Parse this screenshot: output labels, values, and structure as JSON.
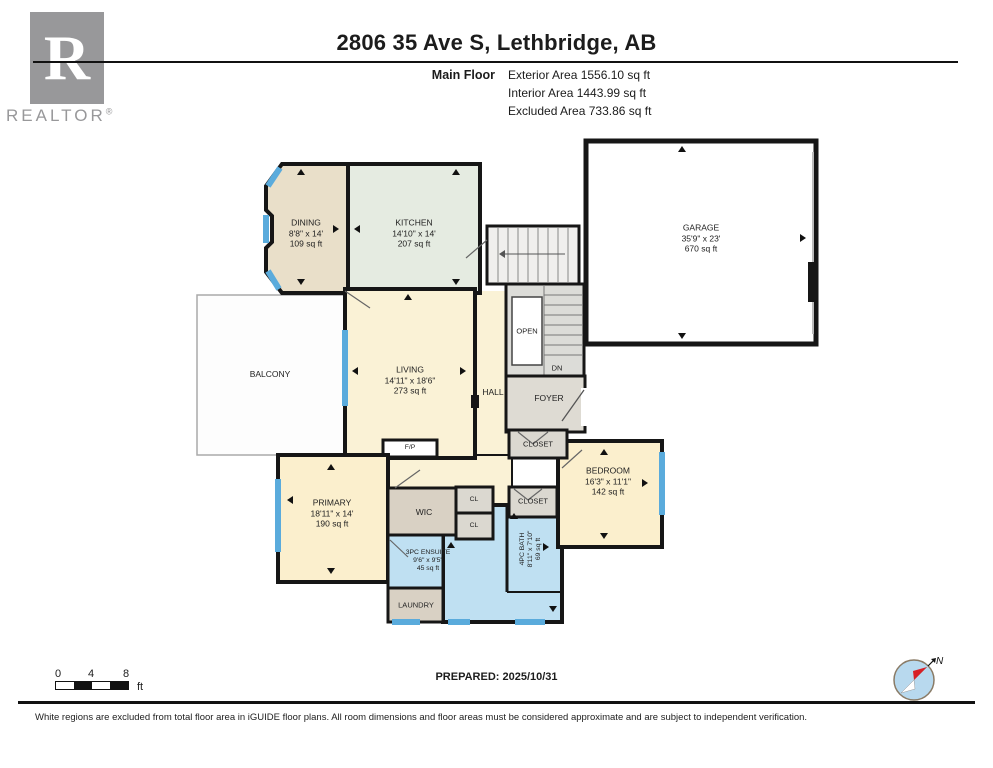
{
  "header": {
    "title": "2806 35 Ave S, Lethbridge, AB",
    "floor_label": "Main Floor",
    "stats": {
      "exterior": "Exterior Area 1556.10 sq ft",
      "interior": "Interior Area 1443.99 sq ft",
      "excluded": "Excluded Area 733.86 sq ft"
    },
    "logo": {
      "letter": "R",
      "word": "REALTOR",
      "registered": "®"
    }
  },
  "rooms": {
    "dining": {
      "name": "DINING",
      "dims": "8'8\" x 14'",
      "area": "109 sq ft"
    },
    "kitchen": {
      "name": "KITCHEN",
      "dims": "14'10\" x 14'",
      "area": "207 sq ft"
    },
    "garage": {
      "name": "GARAGE",
      "dims": "35'9\" x 23'",
      "area": "670 sq ft"
    },
    "balcony": {
      "name": "BALCONY"
    },
    "living": {
      "name": "LIVING",
      "dims": "14'11\" x 18'6\"",
      "area": "273 sq ft"
    },
    "hall": {
      "name": "HALL"
    },
    "open": {
      "name": "OPEN"
    },
    "dn": {
      "name": "DN"
    },
    "foyer": {
      "name": "FOYER"
    },
    "closet1": {
      "name": "CLOSET"
    },
    "closet2": {
      "name": "CLOSET"
    },
    "bedroom": {
      "name": "BEDROOM",
      "dims": "16'3\" x 11'1\"",
      "area": "142 sq ft"
    },
    "primary": {
      "name": "PRIMARY",
      "dims": "18'11\" x 14'",
      "area": "190 sq ft"
    },
    "wic": {
      "name": "WIC"
    },
    "cl1": {
      "name": "CL"
    },
    "cl2": {
      "name": "CL"
    },
    "ensuite": {
      "name": "3PC ENSUITE",
      "dims": "9'6\" x 9'5\"",
      "area": "45 sq ft"
    },
    "bath": {
      "name": "4PC BATH",
      "dims": "8'11\" x 7'10\"",
      "area": "69 sq ft"
    },
    "laundry": {
      "name": "LAUNDRY"
    },
    "fireplace": {
      "name": "F/P"
    }
  },
  "footer": {
    "scale": {
      "ticks": [
        "0",
        "4",
        "8"
      ],
      "unit": "ft"
    },
    "prepared": "PREPARED: 2025/10/31",
    "compass_label": "N",
    "disclaimer": "White regions are excluded from total floor area in iGUIDE floor plans. All room dimensions and floor areas must be considered approximate and are subject to independent verification."
  },
  "colors": {
    "dining_tan": "#e9dfc9",
    "kitchen_mint": "#e5ebe1",
    "cream": "#faf2d6",
    "bedroom_cream": "#fbefcd",
    "bath_blue": "#bfe0f2",
    "window_blue": "#5aabdc",
    "closet_gray": "#dbd8d0",
    "wic_tan": "#d9d1c4",
    "wall": "#161616",
    "logo_gray": "#98989a"
  }
}
